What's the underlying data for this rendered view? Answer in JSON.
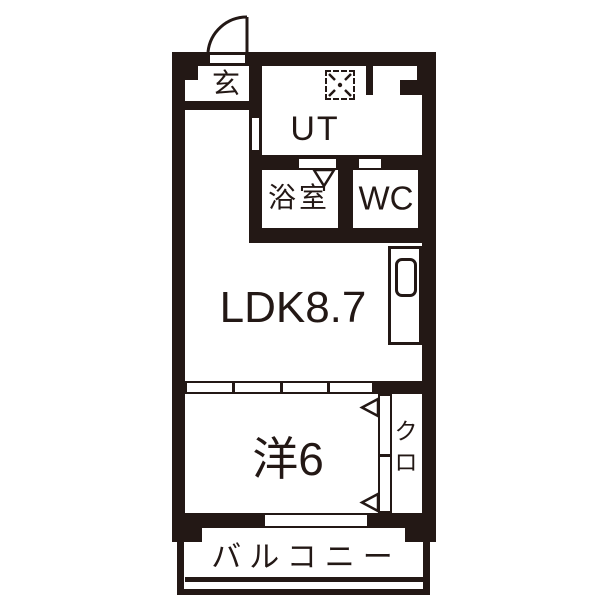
{
  "floorplan": {
    "colors": {
      "ink": "#231815",
      "background": "#ffffff"
    },
    "rooms": {
      "genkan": {
        "label": "玄"
      },
      "utility": {
        "label": "UT"
      },
      "bath": {
        "label": "浴室"
      },
      "toilet": {
        "label": "WC"
      },
      "ldk": {
        "label": "LDK8.7"
      },
      "western_room": {
        "label": "洋6"
      },
      "closet": {
        "chars": [
          "ク",
          "ロ"
        ]
      },
      "balcony": {
        "label": "バルコニー"
      }
    }
  }
}
